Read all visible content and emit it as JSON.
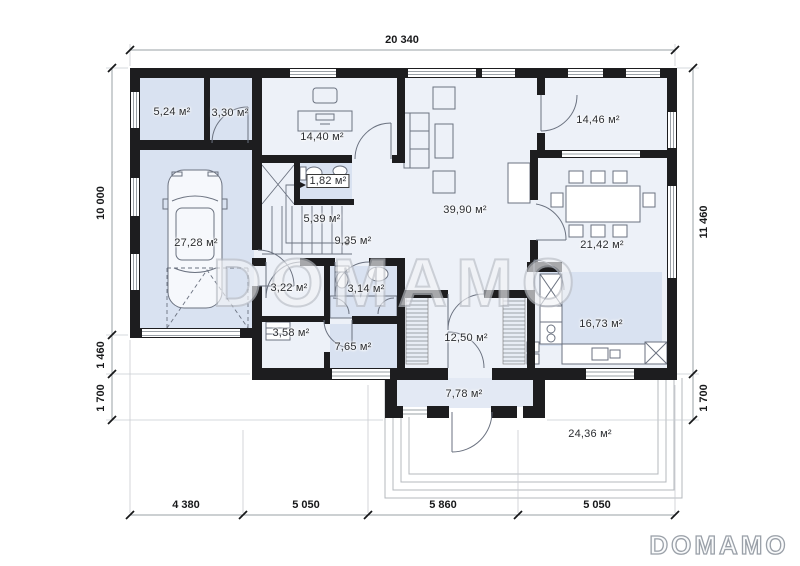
{
  "watermark": {
    "text": "DOMAMO"
  },
  "brand_logo": {
    "text": "DOMAMO"
  },
  "dimensions": {
    "top": "20 340",
    "left": [
      "10 000",
      "1 460",
      "1 700"
    ],
    "right": [
      "11 460",
      "1 700"
    ],
    "bottom": [
      "4 380",
      "5 050",
      "5 860",
      "5 050"
    ]
  },
  "rooms": [
    {
      "id": "room-1",
      "area": "5,24 м²"
    },
    {
      "id": "room-2",
      "area": "3,30 м²"
    },
    {
      "id": "office",
      "area": "14,40 м²"
    },
    {
      "id": "bedroom",
      "area": "14,46 м²"
    },
    {
      "id": "wc",
      "area": "1,82 м²"
    },
    {
      "id": "stairs",
      "area": "5,39 м²"
    },
    {
      "id": "living-room",
      "area": "39,90 м²"
    },
    {
      "id": "garage",
      "area": "27,28 м²"
    },
    {
      "id": "hall",
      "area": "9,35 м²"
    },
    {
      "id": "dining-room",
      "area": "21,42 м²"
    },
    {
      "id": "closet",
      "area": "3,22 м²"
    },
    {
      "id": "bathroom",
      "area": "3,14 м²"
    },
    {
      "id": "pantry",
      "area": "3,58 м²"
    },
    {
      "id": "corridor",
      "area": "7,65 м²"
    },
    {
      "id": "mudroom",
      "area": "12,50 м²"
    },
    {
      "id": "kitchen",
      "area": "16,73 м²"
    },
    {
      "id": "porch",
      "area": "7,78 м²"
    },
    {
      "id": "terrace",
      "area": "24,36 м²"
    }
  ],
  "colors": {
    "wall": "#1d1d1f",
    "floor": "#edf1f8",
    "floor_tint": "#d9e2f1",
    "dimension_text": "#17181a",
    "watermark": "#b9bdc4"
  }
}
